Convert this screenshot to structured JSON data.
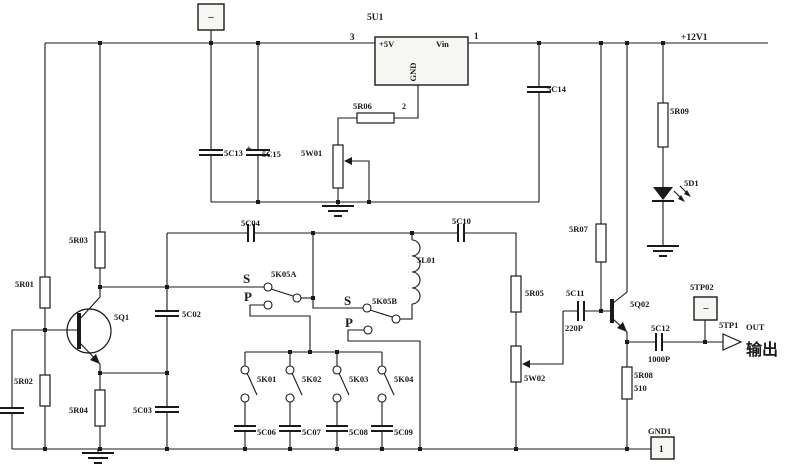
{
  "title": "RF signal generator board schematic sheet 5",
  "colors": {
    "ink": "#1a1a1a",
    "background": "#ffffff",
    "box_fill": "#f6f6f2"
  },
  "power_nets": {
    "positive_rail": "+12V1",
    "regulated": "+5V",
    "ground_port": "GND1"
  },
  "output": {
    "testpoint": "5TP1",
    "port_label": "OUT",
    "chinese_label": "输出"
  },
  "labels": [
    {
      "name": "label-5u1",
      "text": "5U1",
      "x": 367,
      "y": 20,
      "size": 9.5
    },
    {
      "name": "label-pin3",
      "text": "3",
      "x": 350,
      "y": 40,
      "size": 9
    },
    {
      "name": "label-pin1",
      "text": "1",
      "x": 474,
      "y": 39,
      "size": 9
    },
    {
      "name": "label-plus5v",
      "text": "+5V",
      "x": 379,
      "y": 47,
      "size": 8.5
    },
    {
      "name": "label-vin",
      "text": "Vin",
      "x": 436,
      "y": 47,
      "size": 8.5
    },
    {
      "name": "label-gnd-pin",
      "text": "GND",
      "x": 416,
      "y": 72,
      "size": 8.5,
      "rotate": -90,
      "anchor": "middle"
    },
    {
      "name": "label-pin2",
      "text": "2",
      "x": 402,
      "y": 109,
      "size": 8
    },
    {
      "name": "label-5r06",
      "text": "5R06",
      "x": 353,
      "y": 109
    },
    {
      "name": "label-5w01",
      "text": "5W01",
      "x": 301,
      "y": 156
    },
    {
      "name": "label-5c13",
      "text": "5C13",
      "x": 224,
      "y": 156
    },
    {
      "name": "label-5c15-plus",
      "text": "+",
      "x": 246,
      "y": 152,
      "size": 10
    },
    {
      "name": "label-5c15",
      "text": "5C15",
      "x": 262,
      "y": 157
    },
    {
      "name": "label-5c14",
      "text": "5C14",
      "x": 547,
      "y": 92
    },
    {
      "name": "label-plus12v1",
      "text": "+12V1",
      "x": 681,
      "y": 40,
      "size": 9.5
    },
    {
      "name": "label-5r09",
      "text": "5R09",
      "x": 670,
      "y": 114
    },
    {
      "name": "label-5d1",
      "text": "5D1",
      "x": 684,
      "y": 186
    },
    {
      "name": "label-5r07",
      "text": "5R07",
      "x": 569,
      "y": 232
    },
    {
      "name": "label-5r03",
      "text": "5R03",
      "x": 69,
      "y": 243
    },
    {
      "name": "label-5r01",
      "text": "5R01",
      "x": 15,
      "y": 287
    },
    {
      "name": "label-5r02",
      "text": "5R02",
      "x": 14,
      "y": 384
    },
    {
      "name": "label-5r04",
      "text": "5R04",
      "x": 69,
      "y": 413
    },
    {
      "name": "label-5q1",
      "text": "5Q1",
      "x": 114,
      "y": 320
    },
    {
      "name": "label-5c02",
      "text": "5C02",
      "x": 182,
      "y": 317
    },
    {
      "name": "label-5c03",
      "text": "5C03",
      "x": 133,
      "y": 413
    },
    {
      "name": "label-5c04",
      "text": "5C04",
      "x": 241,
      "y": 226
    },
    {
      "name": "label-5k05a-s",
      "text": "S",
      "x": 243,
      "y": 283,
      "size": 13
    },
    {
      "name": "label-5k05a",
      "text": "5K05A",
      "x": 271,
      "y": 277
    },
    {
      "name": "label-5k05a-p",
      "text": "P",
      "x": 244,
      "y": 301,
      "size": 13
    },
    {
      "name": "label-5k05b-s",
      "text": "S",
      "x": 344,
      "y": 305,
      "size": 13
    },
    {
      "name": "label-5k05b",
      "text": "5K05B",
      "x": 372,
      "y": 304
    },
    {
      "name": "label-5k05b-p",
      "text": "P",
      "x": 345,
      "y": 327,
      "size": 13
    },
    {
      "name": "label-5l01",
      "text": "5L01",
      "x": 417,
      "y": 263
    },
    {
      "name": "label-5c10",
      "text": "5C10",
      "x": 452,
      "y": 224
    },
    {
      "name": "label-5r05",
      "text": "5R05",
      "x": 525,
      "y": 296
    },
    {
      "name": "label-5w02",
      "text": "5W02",
      "x": 524,
      "y": 381
    },
    {
      "name": "label-5k01",
      "text": "5K01",
      "x": 257,
      "y": 382
    },
    {
      "name": "label-5k02",
      "text": "5K02",
      "x": 302,
      "y": 382
    },
    {
      "name": "label-5k03",
      "text": "5K03",
      "x": 349,
      "y": 382
    },
    {
      "name": "label-5k04",
      "text": "5K04",
      "x": 394,
      "y": 382
    },
    {
      "name": "label-5c06",
      "text": "5C06",
      "x": 257,
      "y": 435
    },
    {
      "name": "label-5c07",
      "text": "5C07",
      "x": 302,
      "y": 435
    },
    {
      "name": "label-5c08",
      "text": "5C08",
      "x": 349,
      "y": 435
    },
    {
      "name": "label-5c09",
      "text": "5C09",
      "x": 394,
      "y": 435
    },
    {
      "name": "label-5c11",
      "text": "5C11",
      "x": 566,
      "y": 296
    },
    {
      "name": "label-220p",
      "text": "220P",
      "x": 565,
      "y": 331
    },
    {
      "name": "label-5q02",
      "text": "5Q02",
      "x": 630,
      "y": 307
    },
    {
      "name": "label-5c12",
      "text": "5C12",
      "x": 651,
      "y": 331
    },
    {
      "name": "label-1000p",
      "text": "1000P",
      "x": 648,
      "y": 362
    },
    {
      "name": "label-5r08",
      "text": "5R08",
      "x": 634,
      "y": 378
    },
    {
      "name": "label-510",
      "text": "510",
      "x": 634,
      "y": 391
    },
    {
      "name": "label-5tp02",
      "text": "5TP02",
      "x": 690,
      "y": 290
    },
    {
      "name": "label-5tp1",
      "text": "5TP1",
      "x": 719,
      "y": 328
    },
    {
      "name": "label-out",
      "text": "OUT",
      "x": 746,
      "y": 330,
      "size": 8.5
    },
    {
      "name": "label-shuchu",
      "text": "输出",
      "x": 746,
      "y": 355,
      "size": 16
    },
    {
      "name": "label-gnd1",
      "text": "GND1",
      "x": 648,
      "y": 434
    },
    {
      "name": "label-gnd1-pin",
      "text": "1",
      "x": 659,
      "y": 452,
      "size": 9
    },
    {
      "name": "tp-top-minus",
      "text": "−",
      "x": 211,
      "y": 21,
      "size": 11,
      "anchor": "middle"
    },
    {
      "name": "tp02-minus",
      "text": "−",
      "x": 706,
      "y": 312,
      "size": 11,
      "anchor": "middle"
    }
  ]
}
